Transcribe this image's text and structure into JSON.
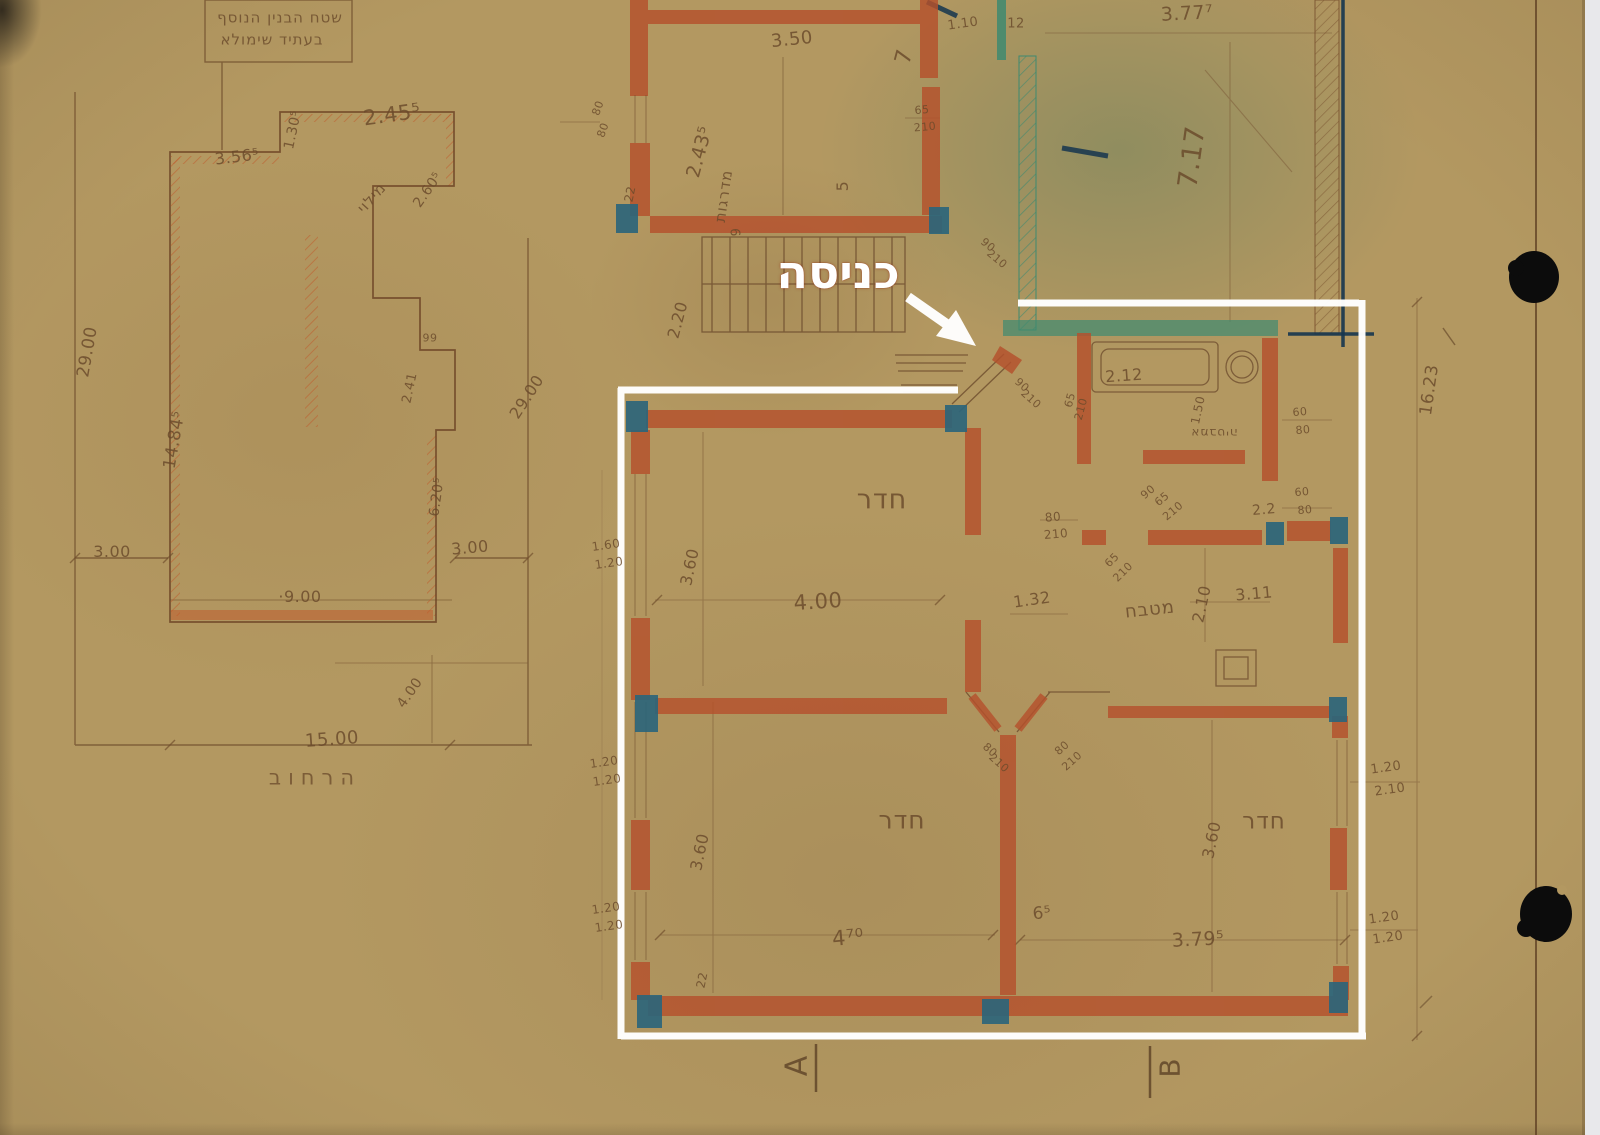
{
  "overlay": {
    "entrance_label": "כניסה"
  },
  "section_markers": {
    "a": "A",
    "b": "B"
  },
  "margin_dim": "16.23",
  "site_plan": {
    "note_line1": "שטח הבנין הנוסף",
    "note_line2": "בעתיד שימולא",
    "street_label": "הרחוב",
    "fill_label": "מילוי",
    "dims": [
      "3.56⁵",
      "1.30⁵",
      "2.45⁵",
      "2.60⁵",
      "29.00",
      "14.84⁵",
      "99",
      "2.41",
      "6.20⁵",
      "29.00",
      "3.00",
      "·9.00",
      "3.00",
      "4.00",
      "15.00"
    ]
  },
  "floor_plan": {
    "stairs_label": "מדרגות",
    "hall_label": "חדר",
    "kitchen_label": "מטבח",
    "bath_label": "אמבטיה",
    "room_bl_label": "חדר",
    "room_br_label": "חדר",
    "dims": [
      "80",
      "80",
      "22",
      "2.43⁵",
      "9",
      "3.50",
      "7",
      "5",
      "65",
      "210",
      "1.10",
      "12",
      "3.77⁷",
      "7.17",
      "2.20",
      "90",
      "210",
      "90",
      "210",
      "80",
      "210",
      "3.60",
      "1.60",
      "1.20",
      "4.00",
      "1.32",
      "2.12",
      "1.50",
      "60",
      "80",
      "65",
      "210",
      "90",
      "65",
      "210",
      "2.2",
      "60",
      "80",
      "2.10",
      "3.11",
      "65",
      "210",
      "3.60",
      "4⁷⁰",
      "1.20",
      "1.20",
      "1.20",
      "1.20",
      "80",
      "210",
      "80",
      "210",
      "6⁵",
      "3.79⁵",
      "3.60",
      "1.20",
      "2.10",
      "1.20",
      "1.20",
      "22"
    ]
  },
  "colors": {
    "paper": "#b39861",
    "wall_red": "#b5512d",
    "column_blue": "#2c657b",
    "wall_teal": "#3e8a70",
    "line_navy": "#16364f",
    "pencil_brown": "#6d4b2a",
    "annotation_white": "#ffffff"
  }
}
